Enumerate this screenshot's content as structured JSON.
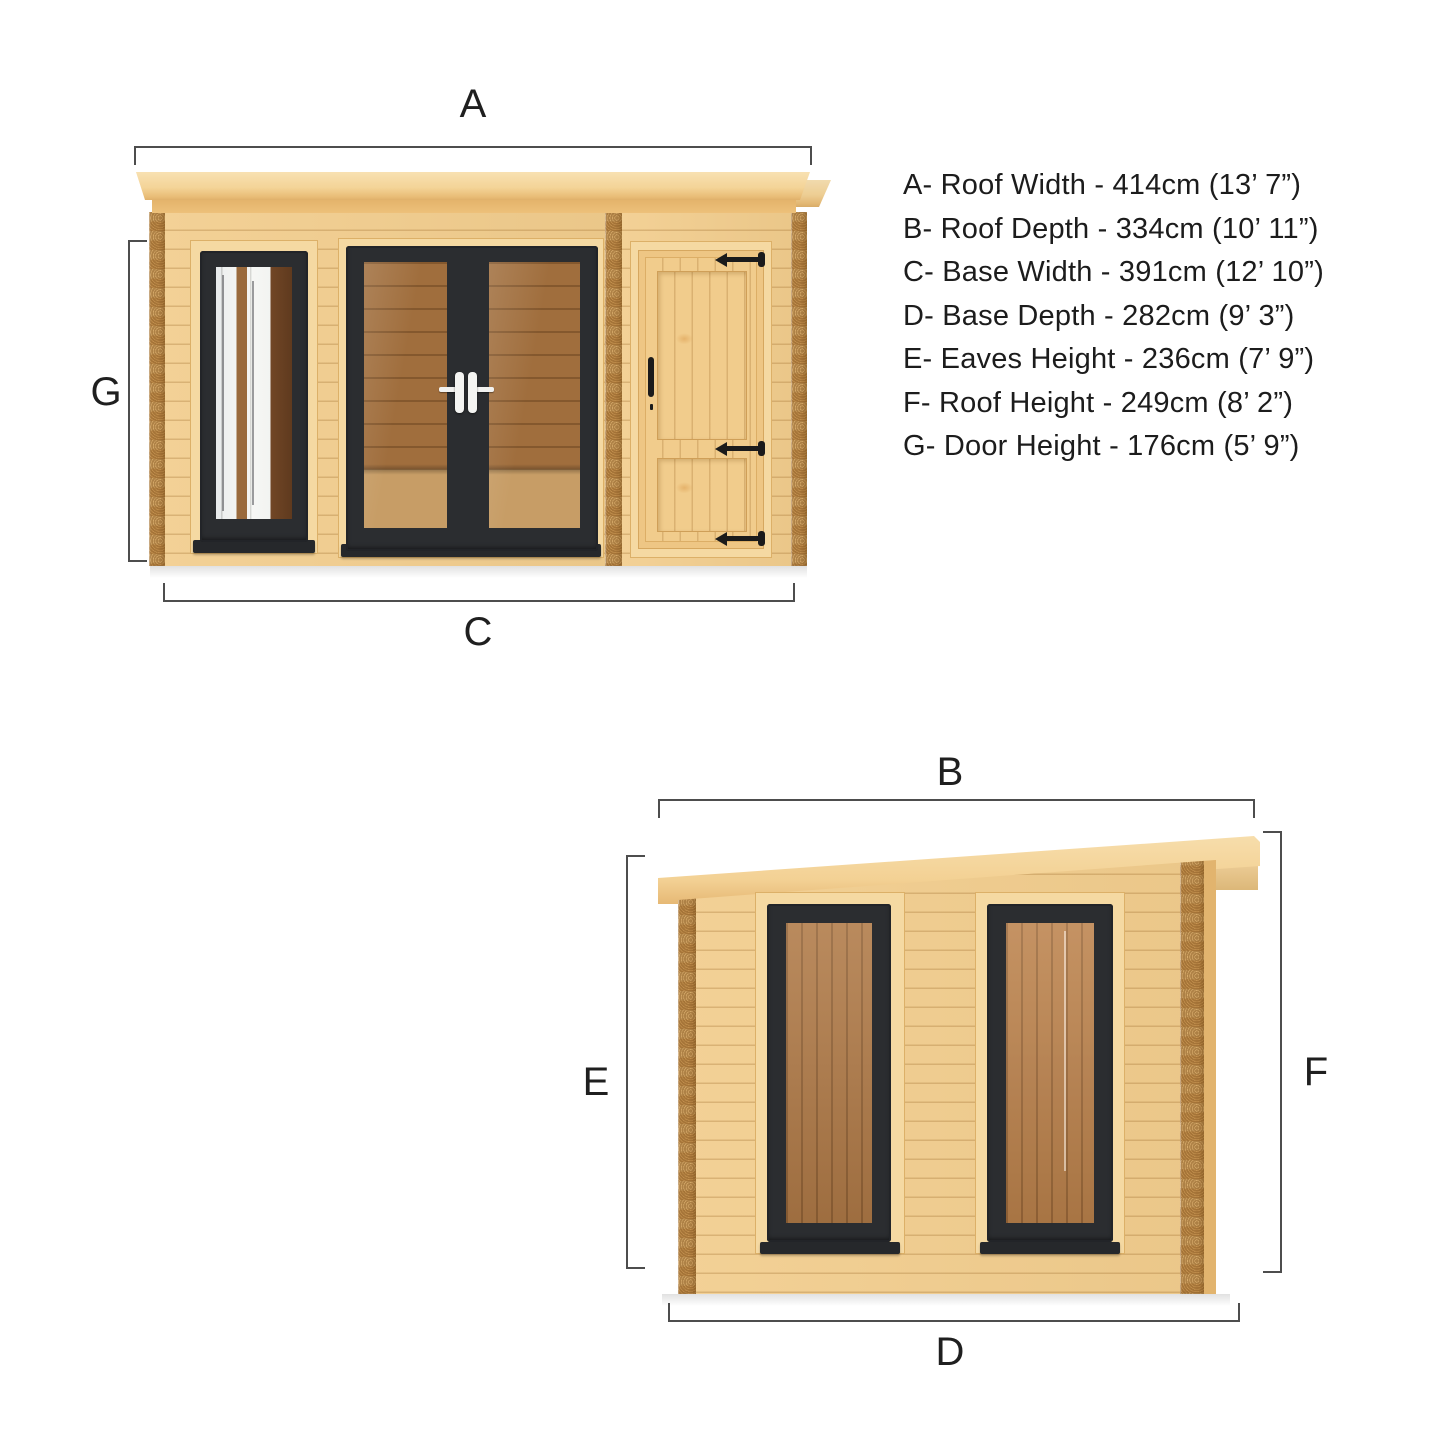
{
  "diagram": {
    "front_view": {
      "labels": {
        "roof_width": "A",
        "door_height": "G",
        "base_width": "C"
      }
    },
    "side_view": {
      "labels": {
        "roof_depth": "B",
        "eaves_height": "E",
        "roof_height": "F",
        "base_depth": "D"
      }
    },
    "key": {
      "items": [
        {
          "letter": "A",
          "text": "A- Roof Width - 414cm (13’ 7”)"
        },
        {
          "letter": "B",
          "text": "B- Roof Depth - 334cm (10’ 11”)"
        },
        {
          "letter": "C",
          "text": "C- Base Width - 391cm (12’ 10”)"
        },
        {
          "letter": "D",
          "text": "D- Base Depth - 282cm (9’ 3”)"
        },
        {
          "letter": "E",
          "text": "E- Eaves Height - 236cm (7’ 9”)"
        },
        {
          "letter": "F",
          "text": "F- Roof Height - 249cm (8’ 2”)"
        },
        {
          "letter": "G",
          "text": "G- Door Height - 176cm (5’ 9”)"
        }
      ]
    },
    "colors": {
      "background": "#ffffff",
      "wall_wood": "#f2cd8d",
      "roof_wood": "#f4d498",
      "frame_dark": "#2b2d30",
      "interior_wood": "#a06e3d",
      "hinge_black": "#1b1b1b",
      "handle_white": "#f2f2f0",
      "dimension_line": "#4d4d4d",
      "roof_knot": "#4f2f12"
    }
  }
}
